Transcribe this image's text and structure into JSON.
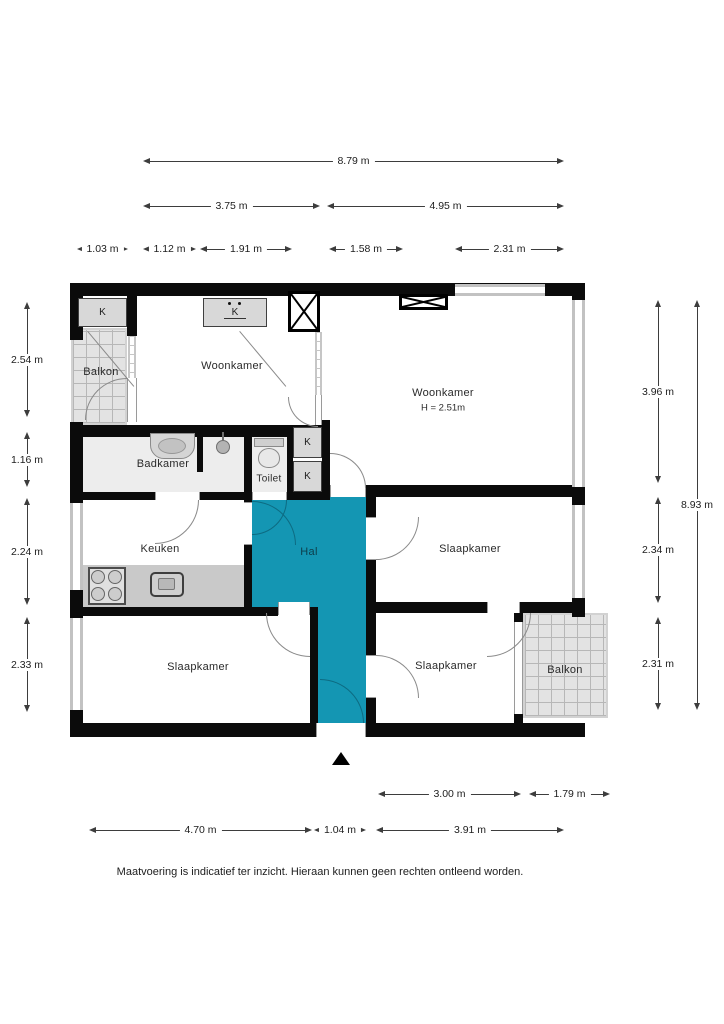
{
  "plan": {
    "rooms": {
      "balkon_tl": "Balkon",
      "woonkamer_left": "Woonkamer",
      "woonkamer_right": "Woonkamer",
      "woonkamer_right_height": "H = 2.51m",
      "badkamer": "Badkamer",
      "toilet": "Toilet",
      "keuken": "Keuken",
      "hal": "Hal",
      "slaapkamer_mid": "Slaapkamer",
      "slaapkamer_bl": "Slaapkamer",
      "slaapkamer_br": "Slaapkamer",
      "balkon_br": "Balkon"
    },
    "closet_label": "K",
    "colors": {
      "hal_fill": "#1496b3",
      "wall": "#0b0b0b",
      "balcony_hatch": "#e3e3e3"
    }
  },
  "dims": {
    "top": [
      "8.79 m",
      "3.75 m",
      "4.95 m",
      "1.03 m",
      "1.12 m",
      "1.91 m",
      "1.58 m",
      "2.31 m"
    ],
    "left": [
      "2.54 m",
      "1.16 m",
      "2.24 m",
      "2.33 m"
    ],
    "right": [
      "3.96 m",
      "2.34 m",
      "2.31 m",
      "8.93 m"
    ],
    "bottom": [
      "3.00 m",
      "1.79 m",
      "4.70 m",
      "1.04 m",
      "3.91 m"
    ]
  },
  "footer": {
    "disclaimer": "Maatvoering is indicatief ter inzicht. Hieraan kunnen geen rechten ontleend worden."
  }
}
